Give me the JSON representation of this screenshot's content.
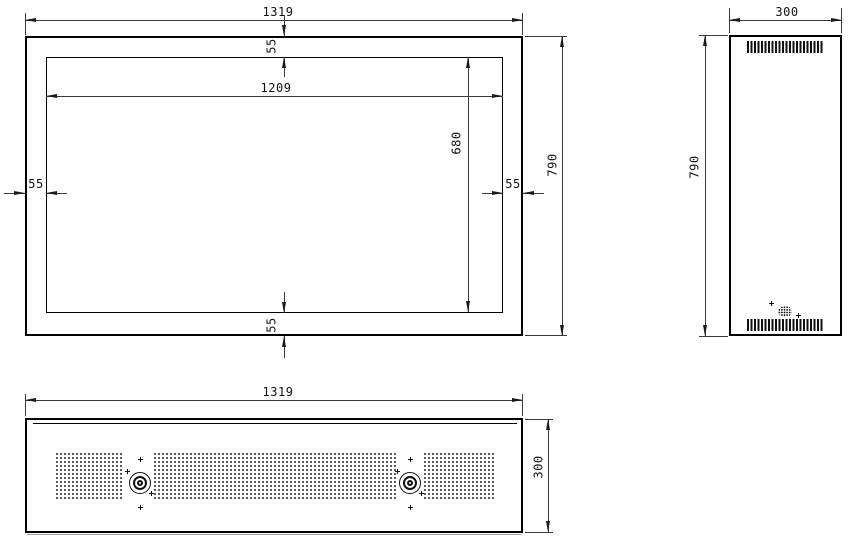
{
  "front_view": {
    "overall_width": "1319",
    "overall_height": "790",
    "opening_width": "1209",
    "opening_height": "680",
    "margin_top": "55",
    "margin_bottom": "55",
    "margin_left": "55",
    "margin_right": "55"
  },
  "side_view": {
    "depth": "300",
    "height": "790"
  },
  "bottom_view": {
    "width": "1319",
    "depth": "300"
  }
}
